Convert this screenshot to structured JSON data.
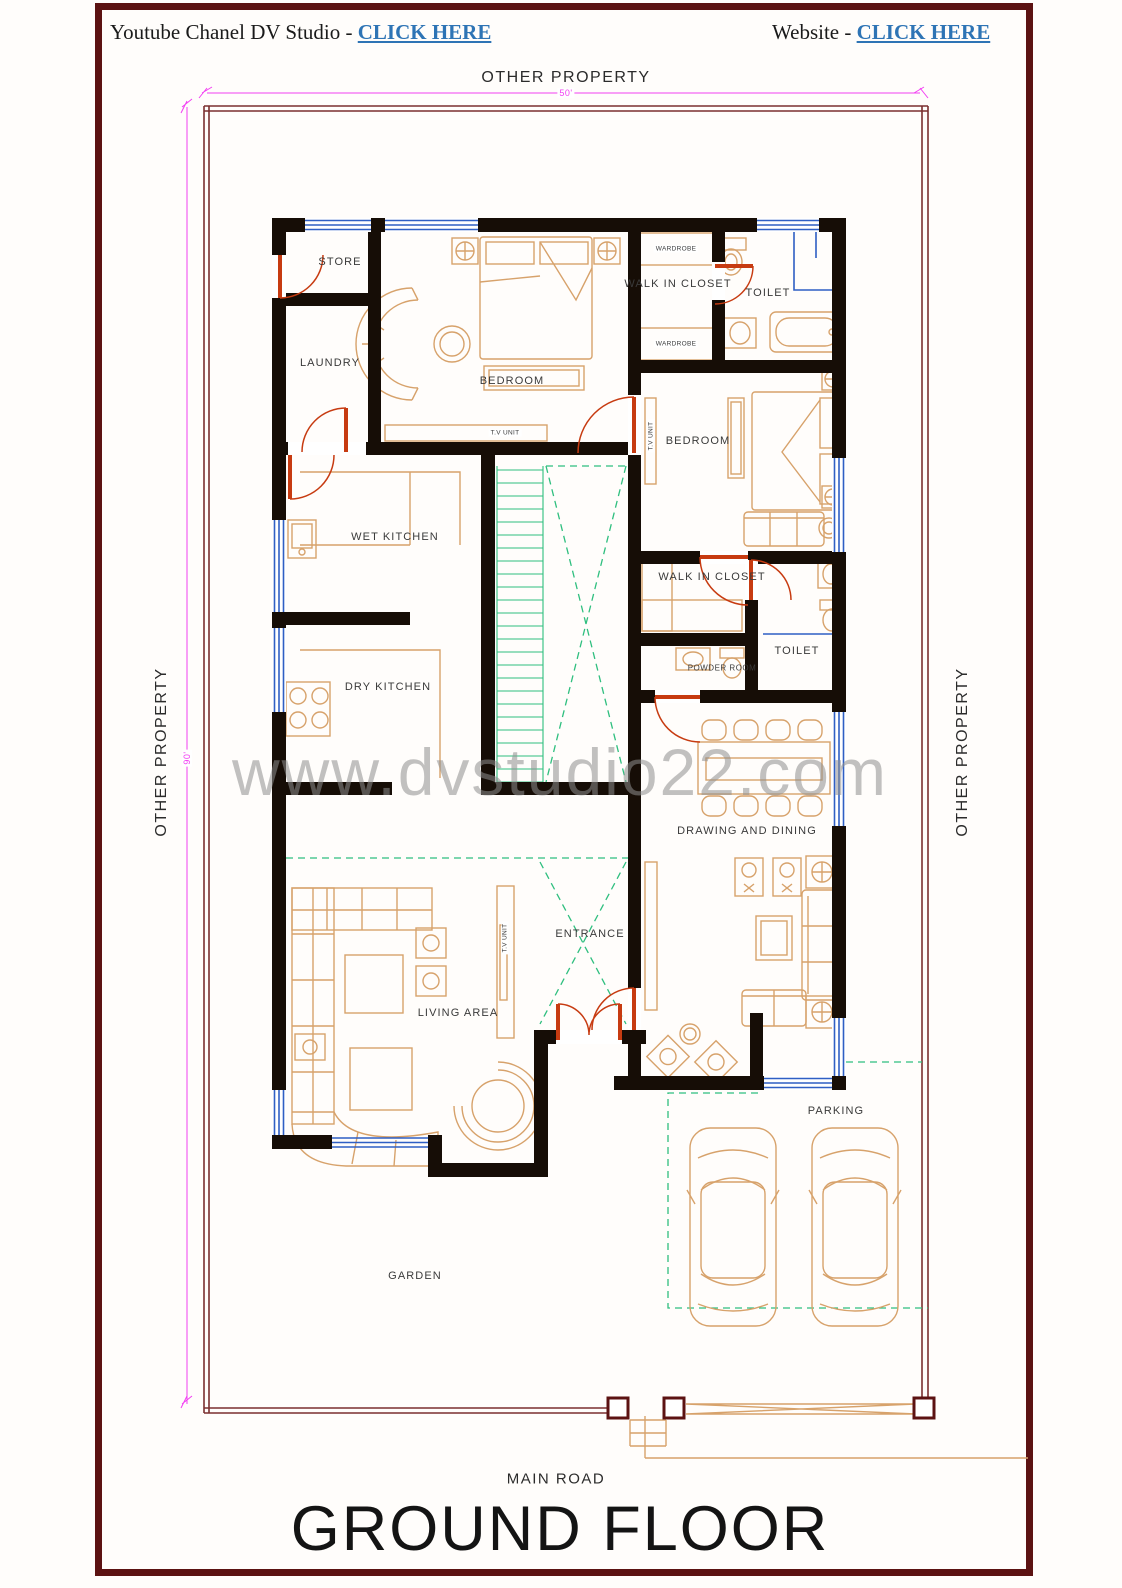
{
  "header": {
    "youtube_prefix": "Youtube Chanel DV Studio - ",
    "youtube_link": "CLICK HERE",
    "website_prefix": "Website - ",
    "website_link": "CLICK HERE"
  },
  "watermark": "www.dvstudio22.com",
  "plan": {
    "boundary_labels": {
      "top": "OTHER PROPERTY",
      "left": "OTHER PROPERTY",
      "right": "OTHER PROPERTY",
      "bottom": "MAIN ROAD"
    },
    "dimensions": {
      "width": "50'",
      "height": "90'"
    },
    "rooms": {
      "store": "STORE",
      "laundry": "LAUNDRY",
      "bedroom1": "BEDROOM",
      "walk_in_closet1": "WALK IN CLOSET",
      "toilet1": "TOILET",
      "bedroom2": "BEDROOM",
      "wet_kitchen": "WET KITCHEN",
      "dry_kitchen": "DRY KITCHEN",
      "walk_in_closet2": "WALK IN CLOSET",
      "toilet2": "TOILET",
      "powder_room": "POWDER ROOM",
      "drawing_dining": "DRAWING AND DINING",
      "entrance": "ENTRANCE",
      "living_area": "LIVING AREA",
      "parking": "PARKING",
      "garden": "GARDEN"
    },
    "furniture_labels": {
      "tv_unit": "T.V UNIT",
      "wardrobe": "WARDROBE"
    }
  },
  "title": "GROUND FLOOR",
  "colors": {
    "page_border": "#5c1212",
    "boundary": "#7b2f2f",
    "wall": "#160d06",
    "furniture": "#d7a26b",
    "door": "#c73b11",
    "window": "#2f5fc4",
    "green": "#2fbf7f",
    "dimension": "#f23ff2",
    "link": "#2e74b5",
    "watermark": "#8f8f8f"
  }
}
